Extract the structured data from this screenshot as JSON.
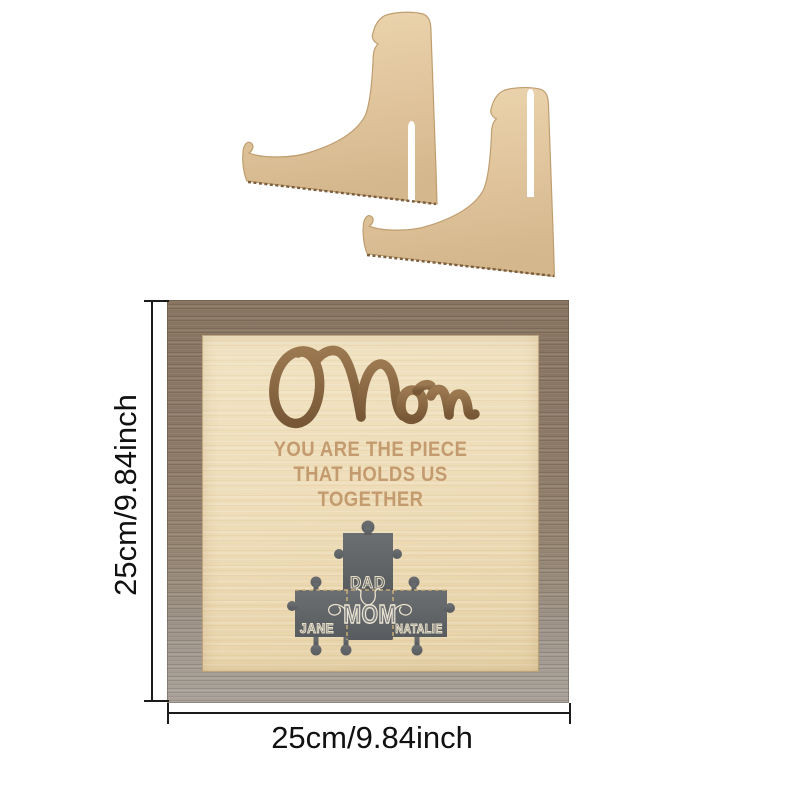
{
  "product": {
    "sign": {
      "script_title": "Mom",
      "tagline_line1": "YOU ARE THE PIECE",
      "tagline_line2": "THAT HOLDS US",
      "tagline_line3": "TOGETHER",
      "puzzle": {
        "top_label": "DAD",
        "center_label": "MOM",
        "left_label": "JANE",
        "right_label": "NATALIE"
      }
    },
    "dimensions": {
      "height_label": "25cm/9.84inch",
      "width_label": "25cm/9.84inch"
    },
    "colors": {
      "frame_top": "#8d7a68",
      "frame_bottom": "#aaa39b",
      "panel": "#eedeba",
      "engraving": "#c49b6f",
      "script_wood": "#8a6746",
      "puzzle_gray": "#616568",
      "stand_wood": "#e3c9a0",
      "dimension_line": "#1b1b1b"
    }
  }
}
